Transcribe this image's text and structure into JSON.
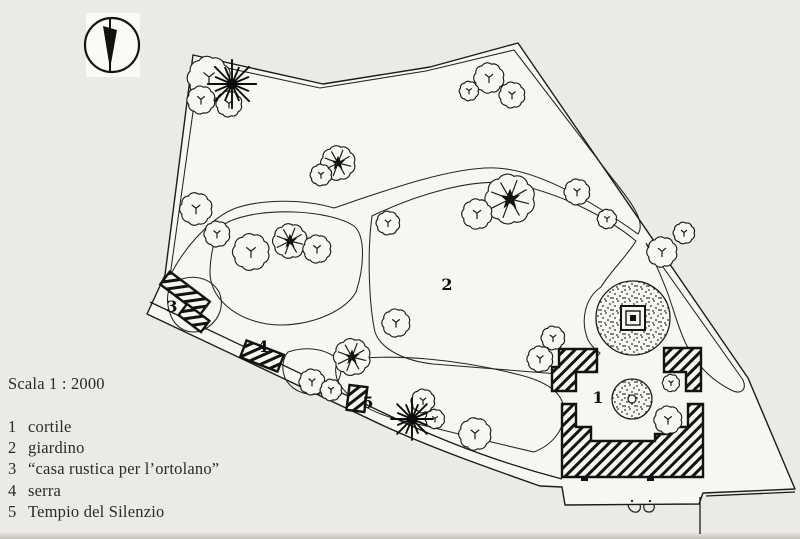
{
  "figure": {
    "scale_label": "Scala 1 : 2000",
    "legend_items": [
      {
        "number": "1",
        "label": "cortile"
      },
      {
        "number": "2",
        "label": "giardino"
      },
      {
        "number": "3",
        "label": "“casa rustica per l’ortolano”"
      },
      {
        "number": "4",
        "label": "serra"
      },
      {
        "number": "5",
        "label": "Tempio del Silenzio"
      }
    ],
    "map_markers": {
      "m1": "1",
      "m2": "2",
      "m3": "3",
      "m4": "4",
      "m5": "5"
    },
    "icons": {
      "north_arrow": "north-arrow"
    },
    "colors": {
      "paper": "#eceae5",
      "drawing_paper": "#f8f6f1",
      "ink": "#1c1c1c"
    }
  }
}
